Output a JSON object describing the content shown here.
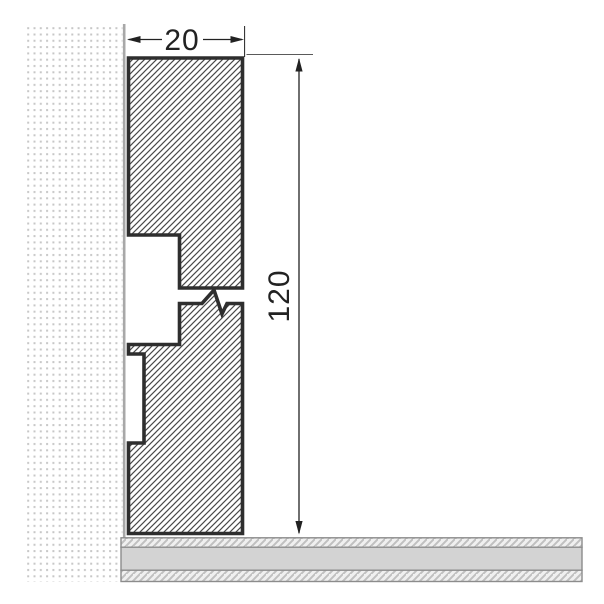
{
  "drawing": {
    "type": "technical-cross-section",
    "dimensions": {
      "width": {
        "label": "20",
        "orientation": "horizontal"
      },
      "height": {
        "label": "120",
        "orientation": "vertical"
      }
    },
    "elements": {
      "wall": "stippled-wall-section",
      "profile": "hatched-skirting-profile",
      "break_mark": "zigzag-break-line",
      "floor": "three-layer-floor-section"
    }
  },
  "colors": {
    "outline": "#2e2e2e",
    "dimension": "#222222",
    "wall_dot": "#c7c7c7",
    "wall_edge": "#a8a8a8",
    "profile_hatch_line": "#474747",
    "floor_solid": "#d3d3d3",
    "floor_border": "#8c8c8c",
    "floor_hatch_line": "#c0c0c0",
    "floor_hatch_bg": "#f0f0f0"
  }
}
